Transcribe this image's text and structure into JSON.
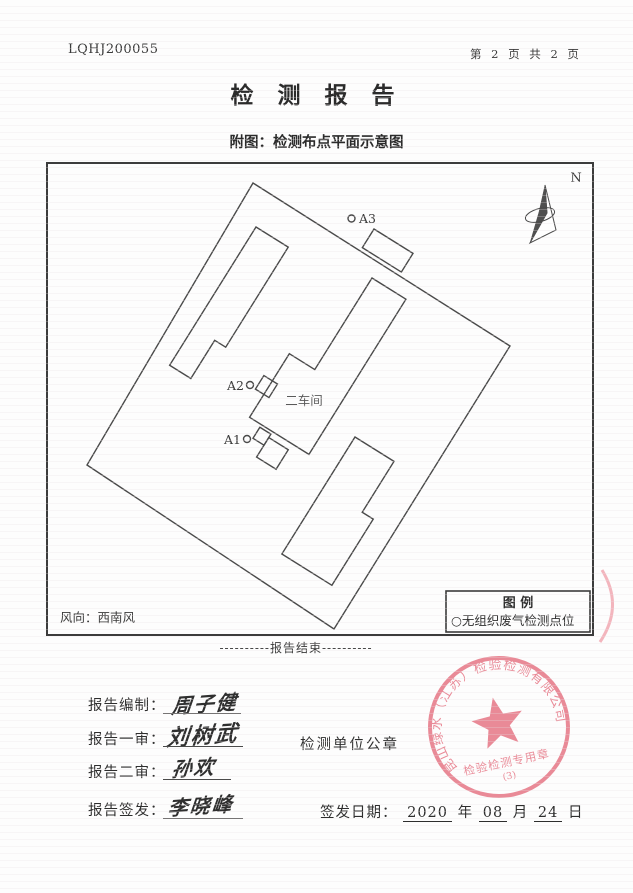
{
  "page": {
    "report_no": "LQHJ200055",
    "page_indicator": "第 2 页 共 2 页",
    "title": "检 测 报 告",
    "subtitle": "附图：检测布点平面示意图",
    "end_marker": "----------报告结束----------"
  },
  "diagram": {
    "north_label": "N",
    "wind_direction": "风向：西南风",
    "workshop_label": "二车间",
    "points": [
      {
        "id": "A1"
      },
      {
        "id": "A2"
      },
      {
        "id": "A3"
      }
    ],
    "legend": {
      "title": "图  例",
      "item": "○无组织废气检测点位"
    },
    "line_color": "#4a4a4a"
  },
  "signoff": {
    "rows": [
      {
        "label": "报告编制：",
        "signature": "周子健"
      },
      {
        "label": "报告一审：",
        "signature": "刘树武"
      },
      {
        "label": "报告二审：",
        "signature": "孙欢"
      },
      {
        "label": "报告签发：",
        "signature": "李晓峰"
      }
    ],
    "seal_caption": "检测单位公章",
    "issue_date": {
      "label": "签发日期：",
      "year": "2020",
      "year_unit": "年",
      "month": "08",
      "month_unit": "月",
      "day": "24",
      "day_unit": "日"
    }
  },
  "seal": {
    "company": "昆山绿水（江苏）检验检测有限公司",
    "type_text": "检验检测专用章",
    "number": "(3)",
    "color": "#e8818f"
  }
}
